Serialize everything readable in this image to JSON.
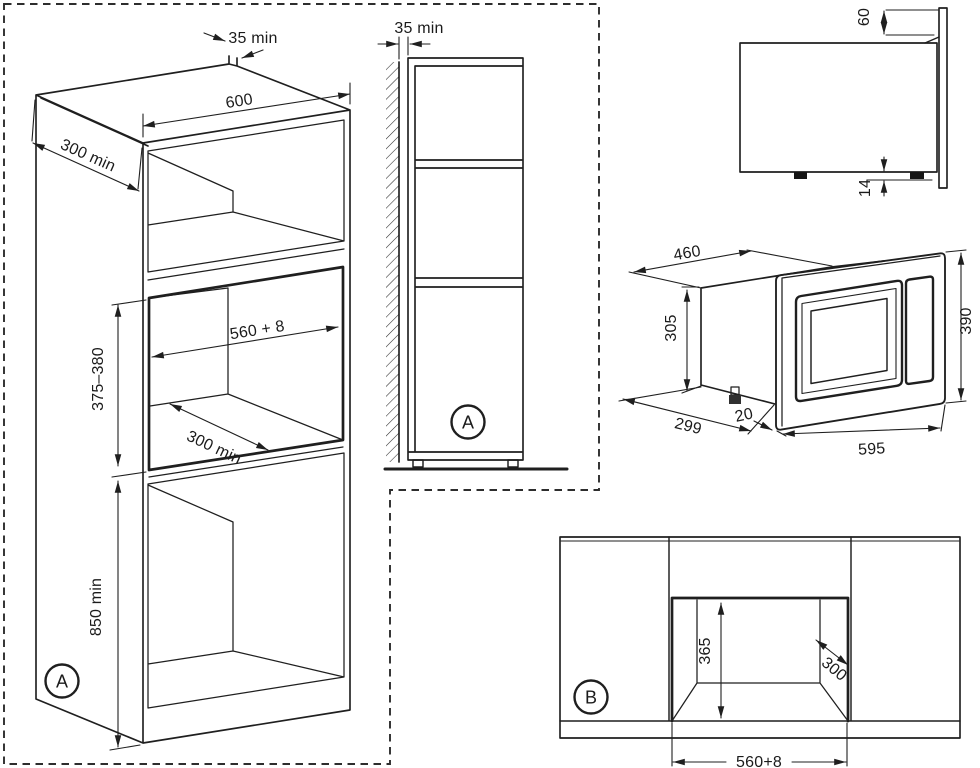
{
  "diagram": {
    "background": "#ffffff",
    "line_color": "#1f1f1f",
    "views": {
      "cabinet_iso": {
        "badge": "A",
        "dims": {
          "wall_gap": "35 min",
          "width": "600",
          "side_depth": "300 min",
          "niche_width": "560 + 8",
          "niche_height": "375–380",
          "niche_depth": "300 min",
          "plinth_height": "850 min"
        }
      },
      "cabinet_side": {
        "badge": "A",
        "dims": {
          "wall_gap": "35 min"
        }
      },
      "oven_side": {
        "dims": {
          "frame_overhang": "60",
          "foot_height": "14"
        }
      },
      "oven_iso": {
        "dims": {
          "body_width": "460",
          "body_height": "305",
          "body_depth": "299",
          "frame_lip": "20",
          "frame_width": "595",
          "frame_height": "390"
        }
      },
      "niche_front": {
        "badge": "B",
        "dims": {
          "niche_height": "365",
          "niche_depth": "300",
          "niche_width": "560+8"
        }
      }
    }
  }
}
